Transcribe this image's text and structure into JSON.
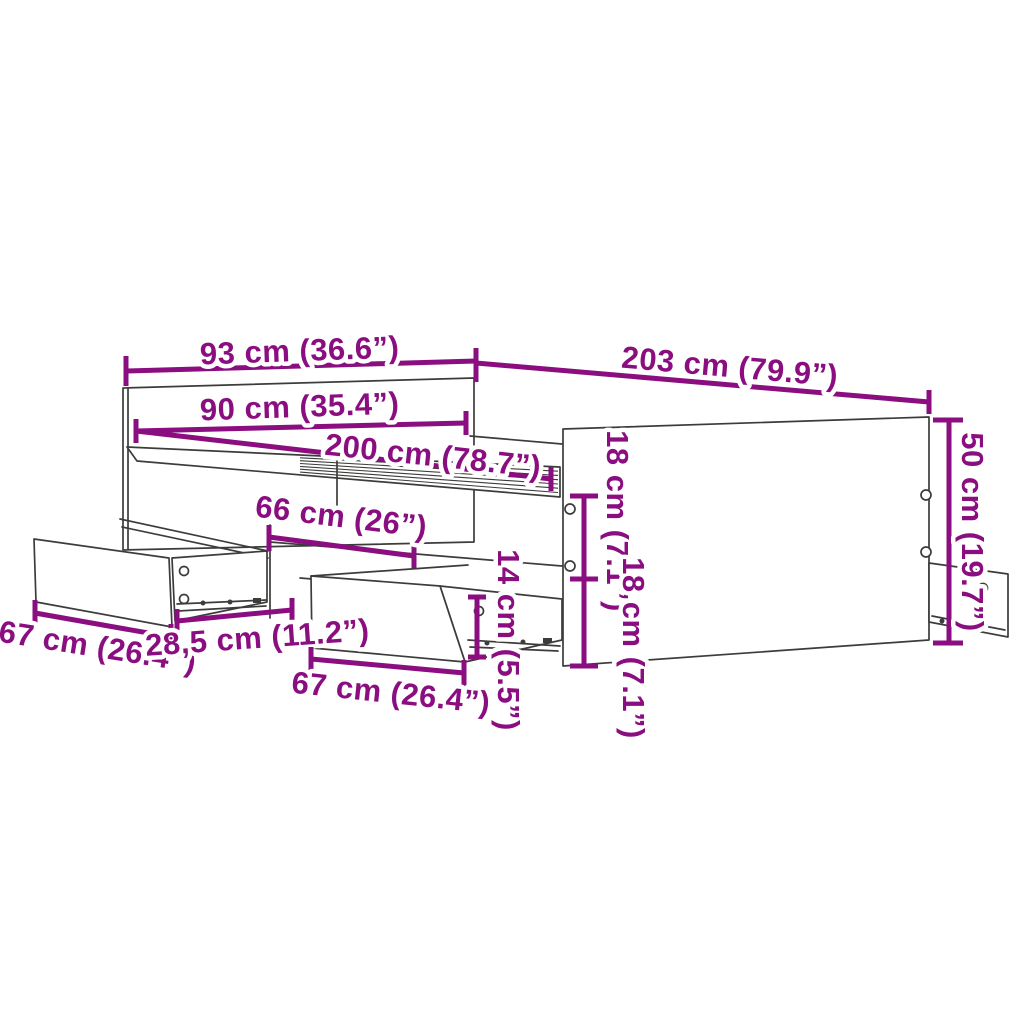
{
  "figure": {
    "subject": "Bed frame with storage drawers — dimension diagram",
    "background": "#FFFFFF"
  },
  "colors": {
    "dimension": "#8A0E80",
    "line_art": "#3C3C3B",
    "background": "#FFFFFF"
  },
  "dimensions": {
    "headboard_width": {
      "cm": 93,
      "inches": 36.6,
      "label": "93 cm (36.6”)"
    },
    "frame_length_outer": {
      "cm": 203,
      "inches": 79.9,
      "label": "203 cm (79.9”)"
    },
    "headboard_width_inner": {
      "cm": 90,
      "inches": 35.4,
      "label": "90 cm (35.4”)"
    },
    "frame_length_inner": {
      "cm": 200,
      "inches": 78.7,
      "label": "200 cm (78.7”)"
    },
    "drawer_opening_width": {
      "cm": 66,
      "inches": 26,
      "label": "66 cm (26”)"
    },
    "side_spacing_top": {
      "cm": 18,
      "inches": 7.1,
      "label": "18 cm (7.1”)"
    },
    "side_spacing_bottom": {
      "cm": 18,
      "inches": 7.1,
      "label": "18 cm (7.1”)"
    },
    "frame_height": {
      "cm": 50,
      "inches": 19.7,
      "label": "50 cm (19.7”)"
    },
    "drawer_height": {
      "cm": 14,
      "inches": 5.5,
      "label": "14 cm (5.5”)"
    },
    "drawer_front_left": {
      "cm": 67,
      "inches": 26.4,
      "label": "67 cm (26.4”)"
    },
    "drawer_spacing": {
      "cm": "28,5",
      "inches": 11.2,
      "label": "28,5 cm (11.2”)"
    },
    "drawer_front_center": {
      "cm": 67,
      "inches": 26.4,
      "label": "67 cm (26.4”)"
    }
  }
}
